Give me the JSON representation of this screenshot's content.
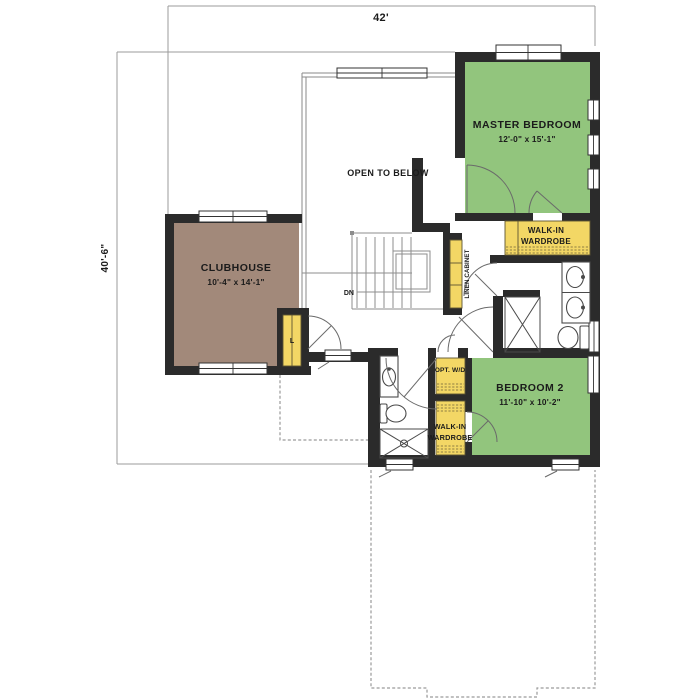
{
  "colors": {
    "room_green": "#92c57d",
    "room_brown": "#a2897a",
    "cabinet_yellow": "#f3d765",
    "wall_dark": "#2b2b2b"
  },
  "dimensions": {
    "overall_width": "42'",
    "overall_height": "40'-6\""
  },
  "rooms": {
    "master_bedroom": {
      "name": "MASTER BEDROOM",
      "size": "12'-0\" x 15'-1\""
    },
    "clubhouse": {
      "name": "CLUBHOUSE",
      "size": "10'-4\" x 14'-1\""
    },
    "bedroom_2": {
      "name": "BEDROOM 2",
      "size": "11'-10\" x 10'-2\""
    },
    "open_to_below": {
      "name": "OPEN TO BELOW"
    }
  },
  "closets": {
    "master_wardrobe": [
      "WALK-IN",
      "WARDROBE"
    ],
    "bedroom2_wardrobe": [
      "WALK-IN",
      "WARDROBE"
    ],
    "optional_washer_dryer": "OPT. W/D",
    "linen_cabinet": "LINEN CABINET",
    "linen_closet_abbr": "L"
  },
  "stairs": {
    "down_label": "DN"
  }
}
